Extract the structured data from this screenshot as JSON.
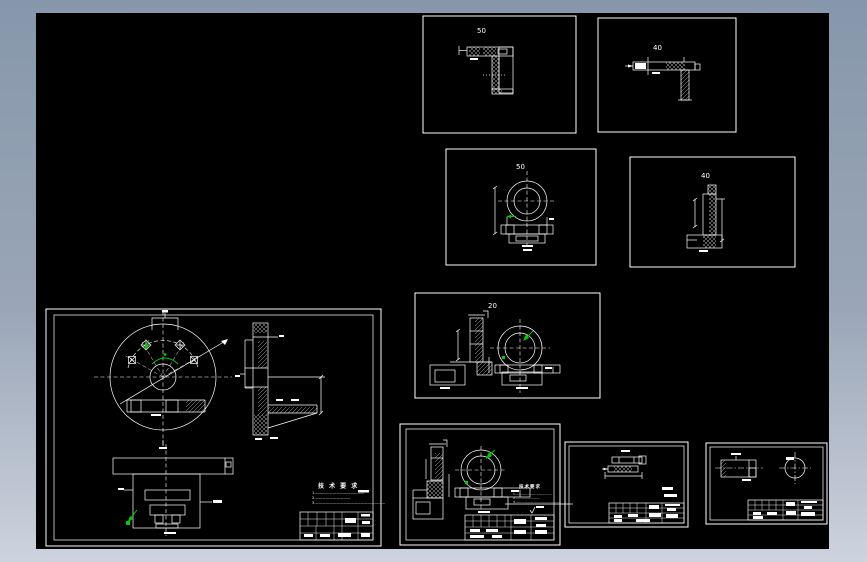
{
  "workspace": {
    "colors": {
      "paper_frame_top": "#8797ab",
      "paper_frame_bottom": "#cdd3de",
      "model_space": "#000000",
      "line": "#ffffff",
      "highlight_green": "#00cc00"
    },
    "viewport_labels": {
      "l_section_top_left": "50",
      "l_section_top_right": "40",
      "bracket_front": "50",
      "bracket_side": "40",
      "bracket_two_view": "20"
    },
    "main_sheet": {
      "tech_req_heading": "技 术 要 求",
      "tech_req_lines": [
        "1.——————————————",
        "2.——————————",
        "3.————————————————————"
      ]
    },
    "sub_sheet": {
      "tech_req_heading": "技术要求",
      "tech_req_lines": [
        "1.————————————",
        "2.————————",
        "3.———————————————"
      ]
    }
  }
}
